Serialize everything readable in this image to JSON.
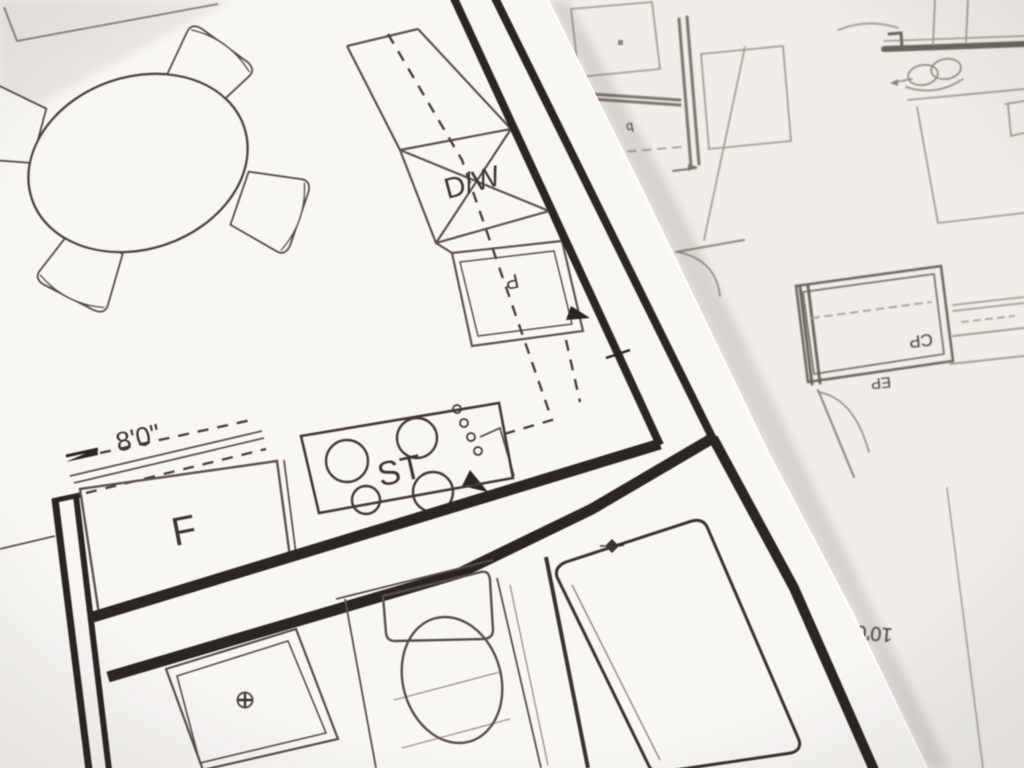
{
  "scene_title": "floor plan blueprints photo",
  "colors": {
    "ink": "#2b2723",
    "thin_ink": "#55504a",
    "faint_ink": "#a39d93",
    "paper_top": "#f9f7f4",
    "paper_bottom": "#f1eeea",
    "background": "#e7e4e0"
  },
  "top_sheet": {
    "labels": {
      "dishwasher": "D/W",
      "stove": "ST",
      "fridge": "F",
      "pantry_letter": "P",
      "width_dimension": "8'0\""
    },
    "fixtures": [
      "dining-table",
      "chair",
      "dishwasher",
      "stove",
      "fridge",
      "pantry-cabinet",
      "shower",
      "toilet",
      "bathtub"
    ]
  },
  "bottom_sheet": {
    "labels": {
      "closet_cp": "CP",
      "closet_ep": "EP",
      "dimension_long": "10'0",
      "dimension_short": "6'0"
    },
    "fixtures": [
      "double-sink",
      "closet",
      "door-swing"
    ]
  }
}
